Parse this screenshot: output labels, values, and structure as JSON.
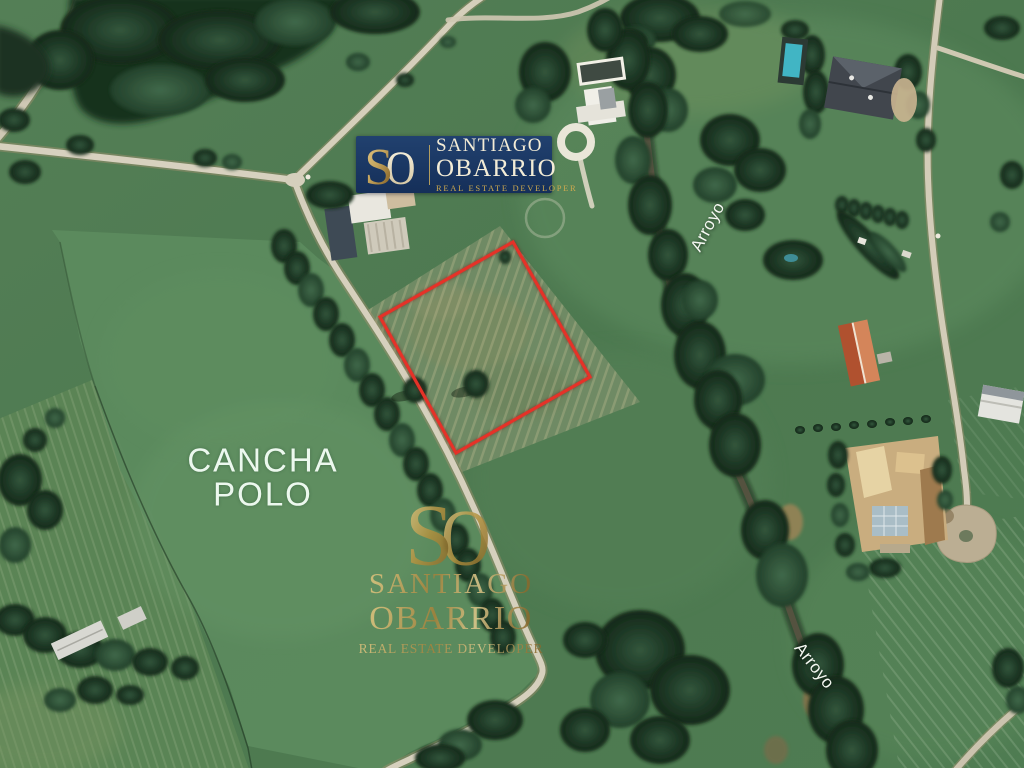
{
  "brand": {
    "monogram_s": "S",
    "monogram_o": "O",
    "name_line1": "SANTIAGO",
    "name_line2": "OBARRIO",
    "tagline": "REAL ESTATE DEVELOPER"
  },
  "map_labels": {
    "polo_line1": "CANCHA",
    "polo_line2": "POLO",
    "stream_upper": "Arroyo",
    "stream_lower": "Arroyo"
  },
  "colors": {
    "logo_background": "#1b3968",
    "logo_cream": "#f3ecd6",
    "brand_gold": "#c4a45c",
    "property_outline": "#e53228"
  }
}
